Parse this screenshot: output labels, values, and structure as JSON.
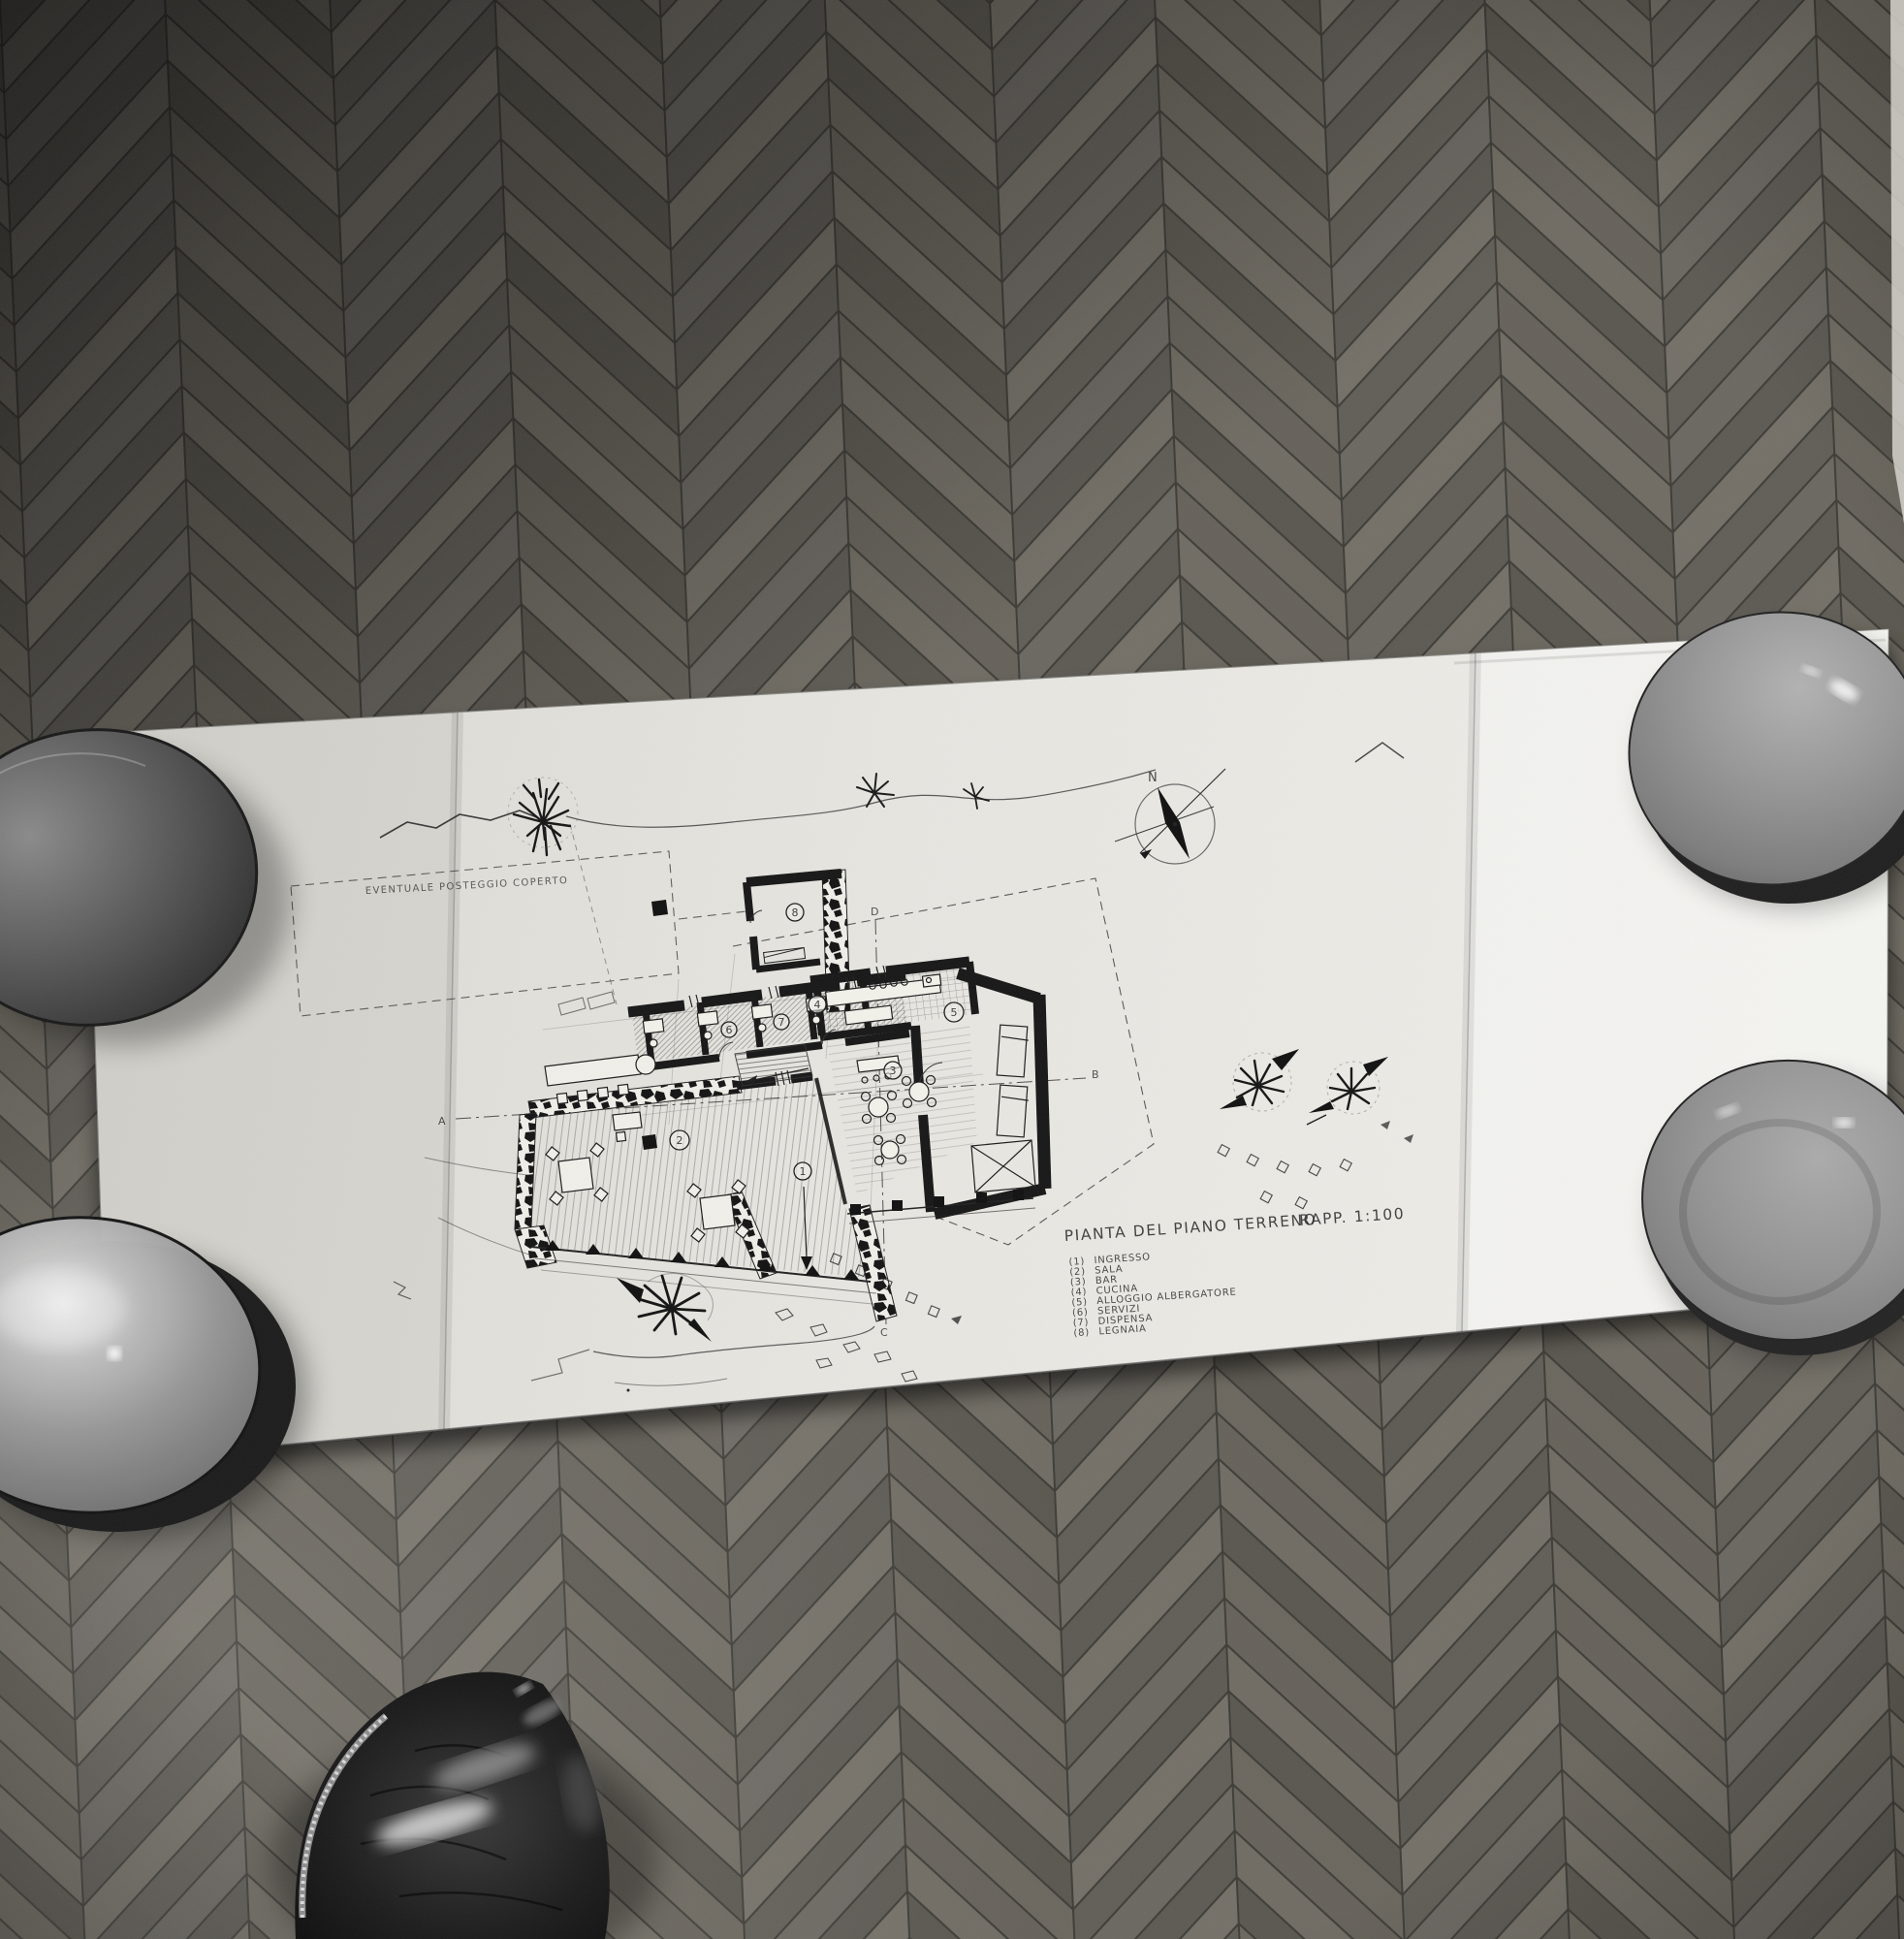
{
  "drawing": {
    "title": "PIANTA DEL PIANO TERRENO",
    "scale_label": "RAPP. 1:100",
    "annotation_posteggio": "EVENTUALE POSTEGGIO COPERTO",
    "compass_north": "N",
    "markers": {
      "a": "A",
      "b": "B",
      "c": "C",
      "d": "D"
    },
    "room_numbers": [
      "1",
      "2",
      "3",
      "4",
      "5",
      "6",
      "7",
      "8"
    ],
    "legend": [
      {
        "num": "(1)",
        "label": "INGRESSO"
      },
      {
        "num": "(2)",
        "label": "SALA"
      },
      {
        "num": "(3)",
        "label": "BAR"
      },
      {
        "num": "(4)",
        "label": "CUCINA"
      },
      {
        "num": "(5)",
        "label": "ALLOGGIO ALBERGATORE"
      },
      {
        "num": "(6)",
        "label": "SERVIZI"
      },
      {
        "num": "(7)",
        "label": "DISPENSA"
      },
      {
        "num": "(8)",
        "label": "LEGNAIA"
      }
    ]
  }
}
